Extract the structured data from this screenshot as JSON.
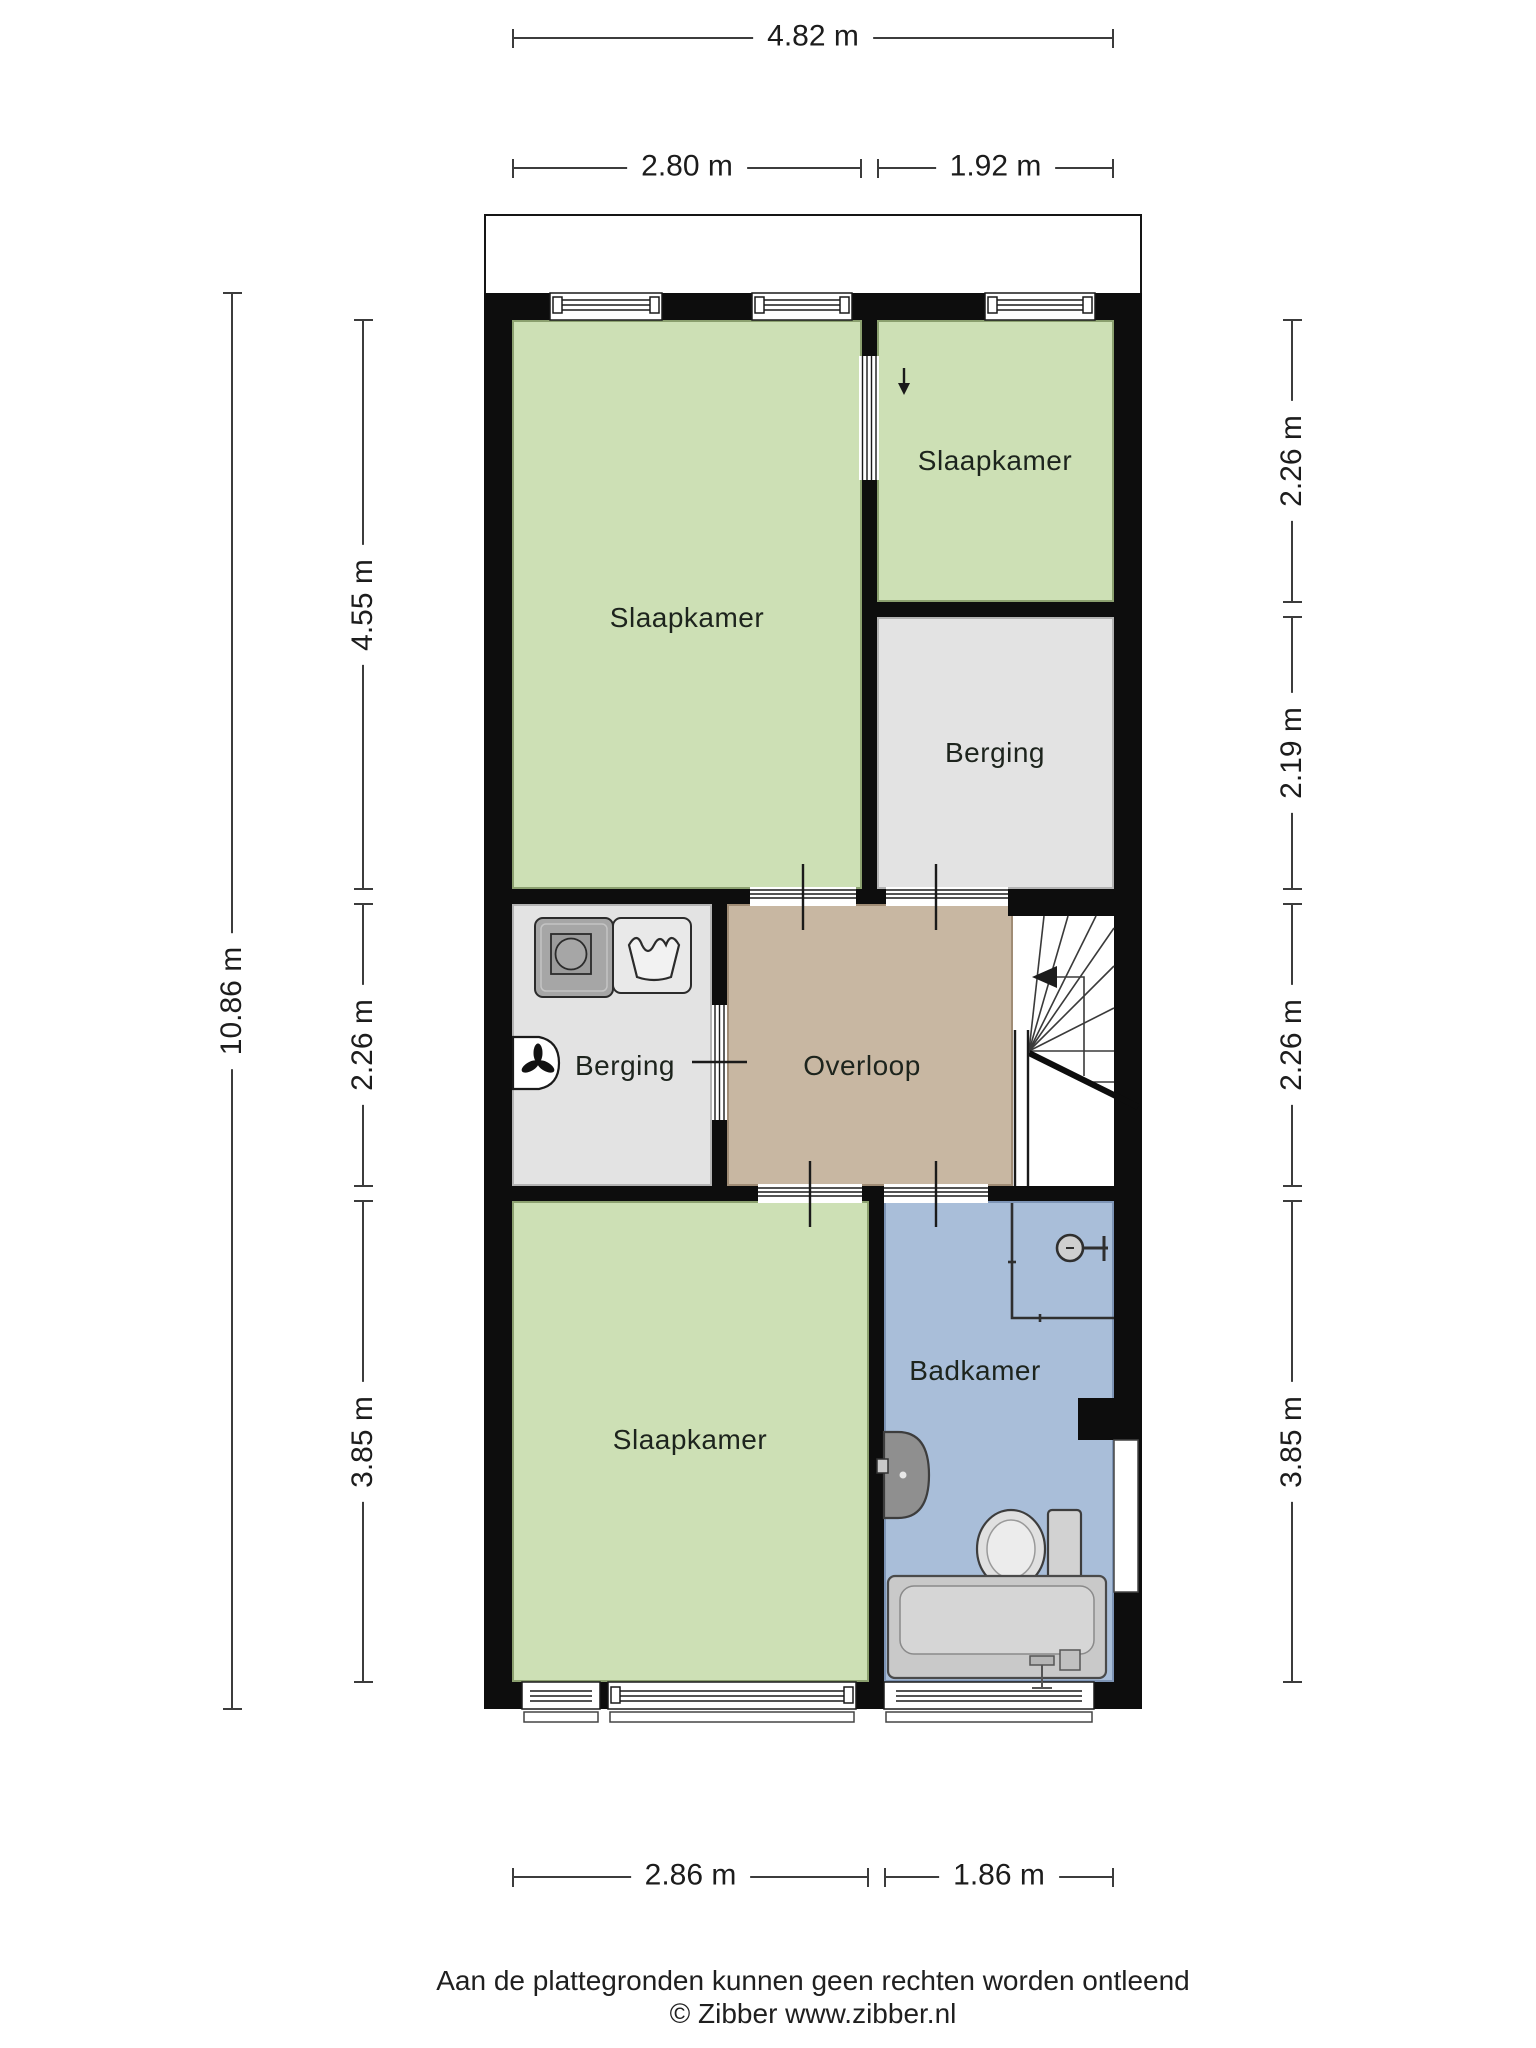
{
  "rooms": {
    "bedroom_large": {
      "label": "Slaapkamer"
    },
    "bedroom_small": {
      "label": "Slaapkamer"
    },
    "storage_top": {
      "label": "Berging"
    },
    "storage_mid": {
      "label": "Berging"
    },
    "landing": {
      "label": "Overloop"
    },
    "bedroom_bottom": {
      "label": "Slaapkamer"
    },
    "bathroom": {
      "label": "Badkamer"
    }
  },
  "dimensions": {
    "top_total": "4.82 m",
    "top_left": "2.80 m",
    "top_right": "1.92 m",
    "left_total": "10.86 m",
    "left_segments": [
      {
        "label": "4.55 m"
      },
      {
        "label": "2.26 m"
      },
      {
        "label": "3.85 m"
      }
    ],
    "right_segments": [
      {
        "label": "2.26 m"
      },
      {
        "label": "2.19 m"
      },
      {
        "label": "2.26 m"
      },
      {
        "label": "3.85 m"
      }
    ],
    "bottom_left": "2.86 m",
    "bottom_right": "1.86 m"
  },
  "fixtures": [
    "washing-machine",
    "laundry-basket",
    "ventilation-unit",
    "stairs",
    "shower",
    "sink",
    "toilet",
    "bathtub"
  ],
  "colors": {
    "wall": "#0d0d0d",
    "room_green": "#cde0b5",
    "room_grey": "#e3e3e3",
    "room_tan": "#c8b7a2",
    "room_blue": "#a9bed9"
  },
  "footer": {
    "disclaimer": "Aan de plattegronden kunnen geen rechten worden ontleend",
    "copyright": "© Zibber www.zibber.nl"
  }
}
